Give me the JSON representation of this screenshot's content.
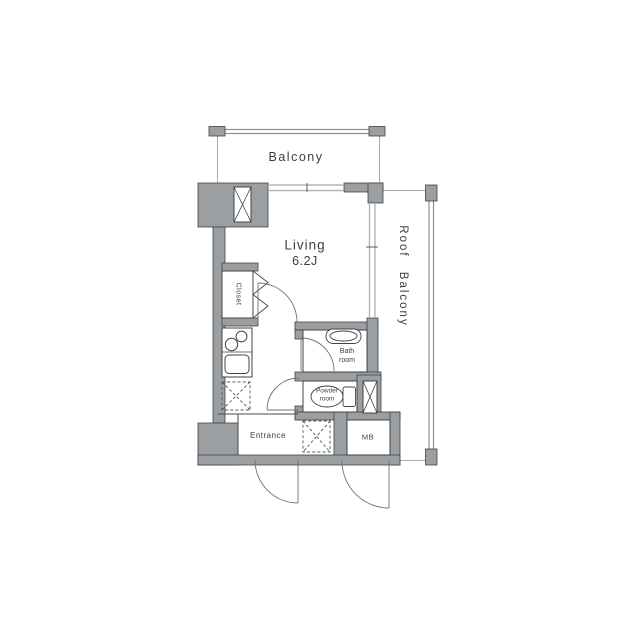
{
  "floorplan": {
    "rooms": {
      "balcony": {
        "label": "Balcony"
      },
      "living": {
        "label": "Living",
        "size": "6.2J"
      },
      "roof_balcony": {
        "label": "Roof Balcony"
      },
      "closet": {
        "label": "Closet"
      },
      "bathroom": {
        "label_line1": "Bath",
        "label_line2": "room"
      },
      "powder_room": {
        "label_line1": "Powder",
        "label_line2": "room"
      },
      "entrance": {
        "label": "Entrance"
      },
      "meter_box": {
        "label": "MB"
      }
    },
    "colors": {
      "background": "#ffffff",
      "wall_fill": "#9b9fa2",
      "wall_edge": "#3f4347",
      "window_line": "#b2b6b8",
      "rail_line": "#8e9294",
      "door_arc": "#6e7274",
      "text": "#3b3e40"
    }
  }
}
